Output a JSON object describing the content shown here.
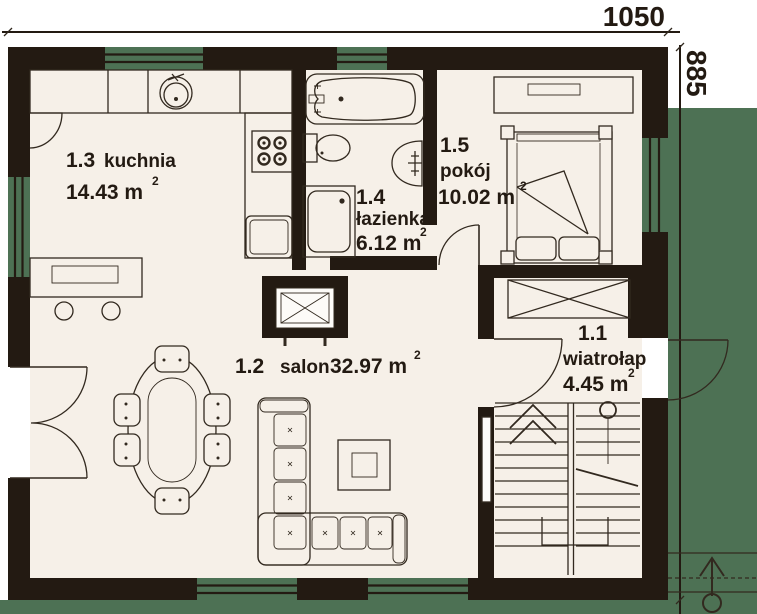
{
  "plan": {
    "dimensions": {
      "top": "1050",
      "right": "885"
    },
    "rooms": [
      {
        "number": "1.1",
        "name": "wiatrołap",
        "area": "4.45 m",
        "sup": "2"
      },
      {
        "number": "1.2",
        "name": "salon",
        "area": "32.97 m",
        "sup": "2"
      },
      {
        "number": "1.3",
        "name": "kuchnia",
        "area": "14.43 m",
        "sup": "2"
      },
      {
        "number": "1.4",
        "name": "łazienka",
        "area": "6.12 m",
        "sup": "2"
      },
      {
        "number": "1.5",
        "name": "pokój",
        "area": "10.02 m",
        "sup": "2"
      }
    ],
    "colors": {
      "wall": "#231a12",
      "floor": "#f6f0e8",
      "accent_green": "#4d7154",
      "line": "#32291f",
      "background": "#ffffff"
    }
  }
}
